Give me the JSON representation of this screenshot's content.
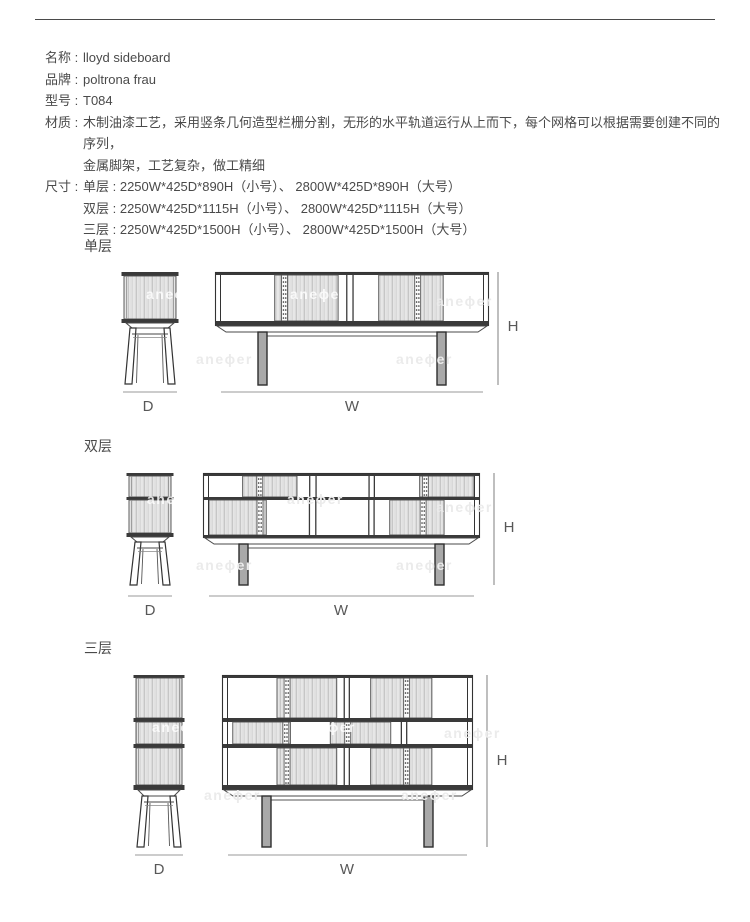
{
  "page": {
    "watermark": "aneϕer",
    "background": "#ffffff",
    "text_color": "#4a4a4a",
    "line_color": "#3a3a3a",
    "dim_line_color": "#999999"
  },
  "specs": [
    {
      "label": "名称 :",
      "lines": [
        "lloyd sideboard"
      ]
    },
    {
      "label": "品牌 :",
      "lines": [
        "poltrona frau"
      ]
    },
    {
      "label": "型号 :",
      "lines": [
        "T084"
      ]
    },
    {
      "label": "材质 :",
      "lines": [
        "木制油漆工艺，采用竖条几何造型栏栅分割，无形的水平轨道运行从上而下，每个网格可以根据需要创建不同的序列，",
        "金属脚架，工艺复杂，做工精细"
      ]
    },
    {
      "label": "尺寸 :",
      "lines": [
        "单层 : 2250W*425D*890H（小号）、 2800W*425D*890H（大号）",
        "双层 : 2250W*425D*1115H（小号）、 2800W*425D*1115H（大号）",
        "三层 : 2250W*425D*1500H（小号）、 2800W*425D*1500H（大号）"
      ]
    }
  ],
  "sections": [
    {
      "title": "单层",
      "dim_labels": {
        "d": "D",
        "w": "W",
        "h": "H"
      },
      "geometry": {
        "side": {
          "x": 123,
          "y": 272,
          "w": 54,
          "cap": 4,
          "rows": [
            43
          ],
          "band": 4,
          "bottom": 4,
          "base": 5,
          "leg_h": 56,
          "dim_y": 392
        },
        "front": {
          "x": 215,
          "y": 272,
          "w": 274,
          "cap": 3,
          "rows": [
            46
          ],
          "band": 3,
          "bottom": 5,
          "base": 6,
          "leg_h": 53,
          "leg_inset": 43,
          "leg_w": 9,
          "dim_y": 392,
          "h_x": 498,
          "cells": [
            [
              {
                "t": "w",
                "f": 0.205
              },
              {
                "t": "s",
                "f": 0.242,
                "d": 0.1
              },
              {
                "t": "w",
                "f": 0.03
              },
              {
                "t": "v",
                "f": 0.03
              },
              {
                "t": "w",
                "f": 0.095
              },
              {
                "t": "s",
                "f": 0.246,
                "d": 0.55
              },
              {
                "t": "w",
                "f": 0.152
              }
            ]
          ]
        }
      }
    },
    {
      "title": "双层",
      "dim_labels": {
        "d": "D",
        "w": "W",
        "h": "H"
      },
      "geometry": {
        "side": {
          "x": 128,
          "y": 473,
          "w": 44,
          "cap": 3,
          "rows": [
            21,
            33
          ],
          "band": 3,
          "bottom": 4,
          "base": 5,
          "leg_h": 43,
          "dim_y": 596
        },
        "front": {
          "x": 203,
          "y": 473,
          "w": 277,
          "cap": 3,
          "rows": [
            21,
            35
          ],
          "band": 3,
          "bottom": 3,
          "base": 6,
          "leg_h": 41,
          "leg_inset": 36,
          "leg_w": 9,
          "dim_y": 596,
          "h_x": 494,
          "cells": [
            [
              {
                "t": "w",
                "f": 0.127
              },
              {
                "t": "s",
                "f": 0.205,
                "d": 0.25
              },
              {
                "t": "w",
                "f": 0.045
              },
              {
                "t": "v",
                "f": 0.03
              },
              {
                "t": "w",
                "f": 0.194
              },
              {
                "t": "v",
                "f": 0.026
              },
              {
                "t": "w",
                "f": 0.168
              },
              {
                "t": "s",
                "f": 0.205,
                "d": 0.04
              }
            ],
            [
              {
                "t": "s",
                "f": 0.216,
                "d": 0.83
              },
              {
                "t": "w",
                "f": 0.16
              },
              {
                "t": "v",
                "f": 0.03
              },
              {
                "t": "w",
                "f": 0.194
              },
              {
                "t": "v",
                "f": 0.026
              },
              {
                "t": "w",
                "f": 0.056
              },
              {
                "t": "s",
                "f": 0.205,
                "d": 0.55
              },
              {
                "t": "w",
                "f": 0.113
              }
            ]
          ]
        }
      }
    },
    {
      "title": "三层",
      "dim_labels": {
        "d": "D",
        "w": "W",
        "h": "H"
      },
      "geometry": {
        "side": {
          "x": 135,
          "y": 675,
          "w": 48,
          "cap": 3,
          "rows": [
            40,
            22,
            37
          ],
          "band": 4,
          "bottom": 5,
          "base": 6,
          "leg_h": 51,
          "dim_y": 855
        },
        "front": {
          "x": 222,
          "y": 675,
          "w": 251,
          "cap": 3,
          "rows": [
            40,
            22,
            37
          ],
          "band": 4,
          "bottom": 5,
          "base": 6,
          "leg_h": 51,
          "leg_inset": 40,
          "leg_w": 9,
          "dim_y": 855,
          "h_x": 487,
          "cells": [
            [
              {
                "t": "w",
                "f": 0.205
              },
              {
                "t": "s",
                "f": 0.25,
                "d": 0.11
              },
              {
                "t": "w",
                "f": 0.028
              },
              {
                "t": "v",
                "f": 0.028
              },
              {
                "t": "w",
                "f": 0.086
              },
              {
                "t": "s",
                "f": 0.256,
                "d": 0.53
              },
              {
                "t": "w",
                "f": 0.147
              }
            ],
            [
              {
                "t": "w",
                "f": 0.02
              },
              {
                "t": "s",
                "f": 0.241,
                "d": 0.86
              },
              {
                "t": "w",
                "f": 0.167
              },
              {
                "t": "s",
                "f": 0.253,
                "d": 0.23
              },
              {
                "t": "w",
                "f": 0.041
              },
              {
                "t": "v",
                "f": 0.029
              },
              {
                "t": "w",
                "f": 0.249
              }
            ],
            [
              {
                "t": "w",
                "f": 0.205
              },
              {
                "t": "s",
                "f": 0.25,
                "d": 0.11
              },
              {
                "t": "w",
                "f": 0.028
              },
              {
                "t": "v",
                "f": 0.028
              },
              {
                "t": "w",
                "f": 0.086
              },
              {
                "t": "s",
                "f": 0.256,
                "d": 0.53
              },
              {
                "t": "w",
                "f": 0.147
              }
            ]
          ]
        }
      }
    }
  ]
}
